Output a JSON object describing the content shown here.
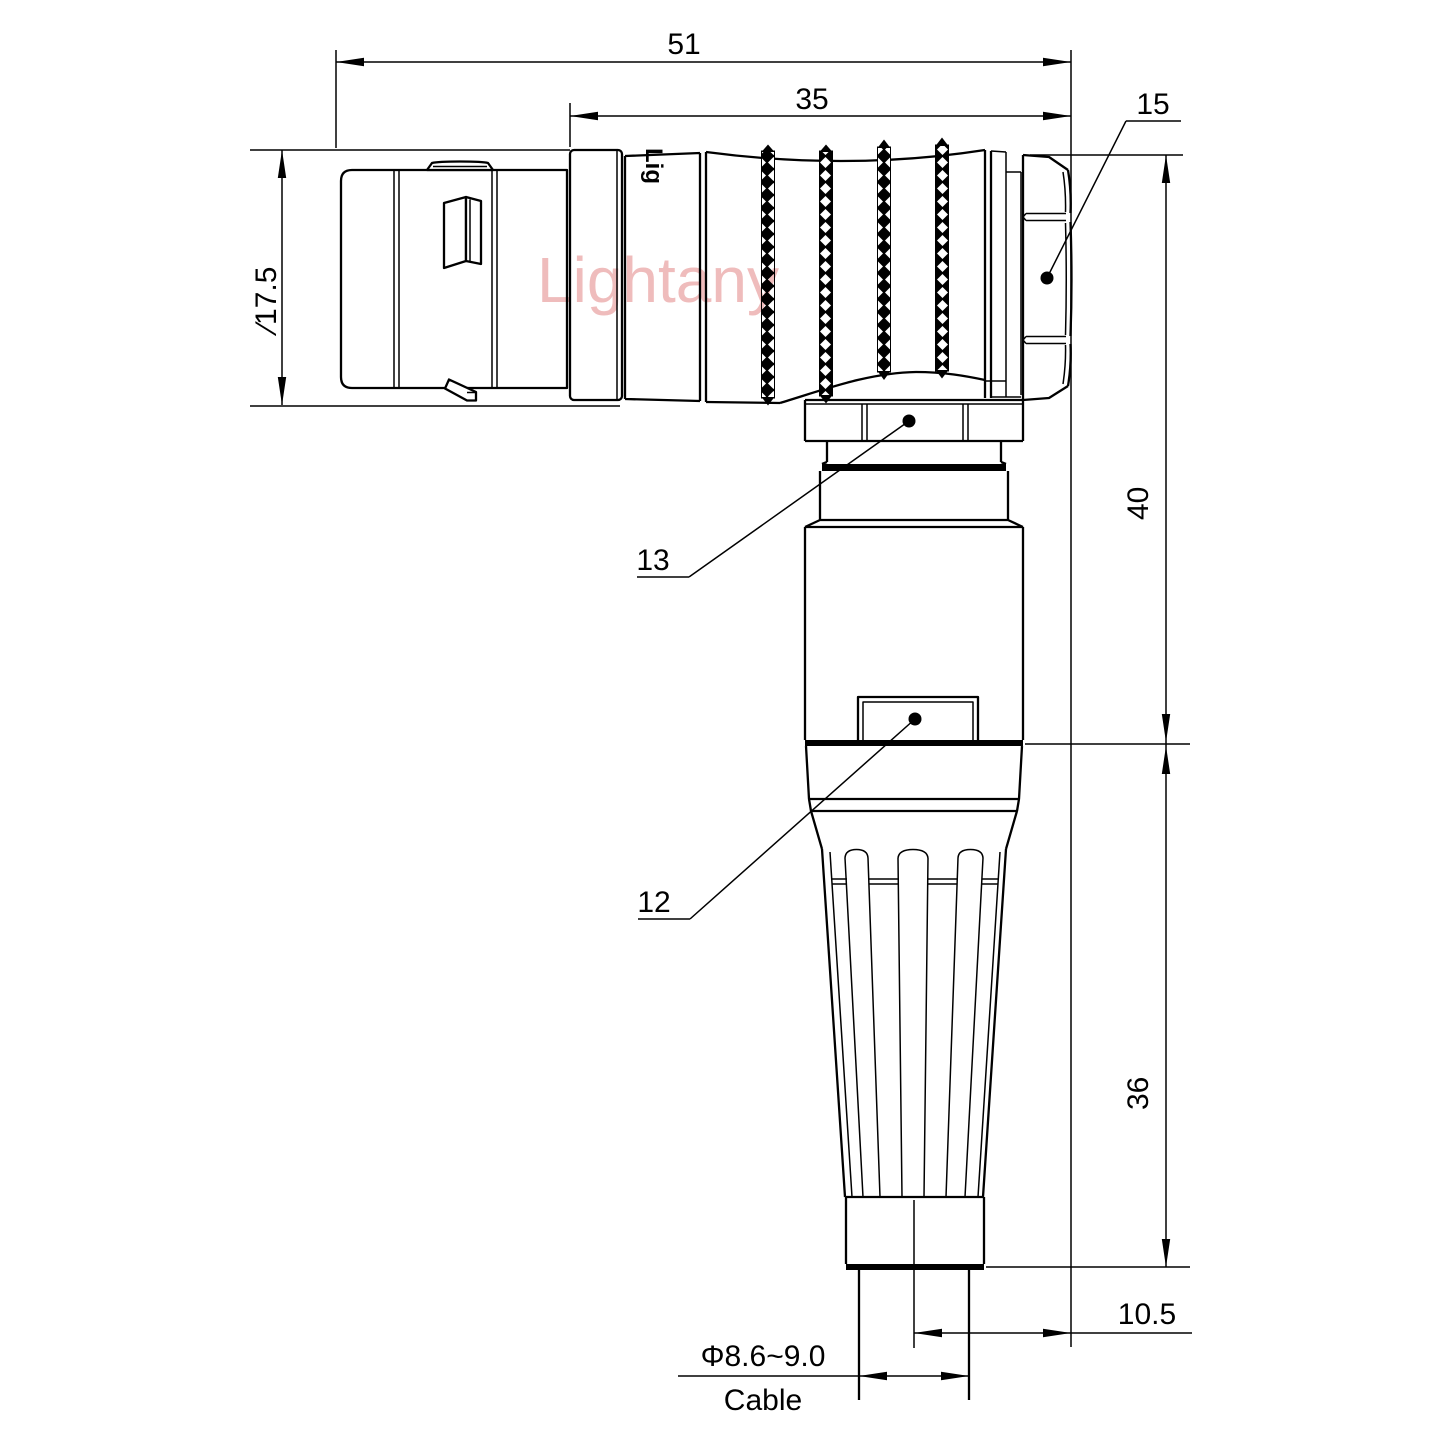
{
  "drawing": {
    "title": "right-angle circular connector technical drawing",
    "colors": {
      "background": "#ffffff",
      "line": "#000000",
      "watermark_pink": "#efbcbc"
    }
  },
  "watermark": {
    "text": "Lightany"
  },
  "engraving": {
    "text": "Lig"
  },
  "dimensions": {
    "overall_length": {
      "value": "51"
    },
    "body_length": {
      "value": "35"
    },
    "shell_diameter": {
      "value": "∕17.5"
    },
    "height_upper": {
      "value": "40"
    },
    "height_lower": {
      "value": "36"
    },
    "offset": {
      "value": "10.5"
    },
    "cable_diameter": {
      "value": "Φ8.6~9.0"
    },
    "cable_label": {
      "value": "Cable"
    }
  },
  "part_labels": {
    "hex_nut": {
      "value": "15"
    },
    "coupling_collar": {
      "value": "13"
    },
    "housing_boss": {
      "value": "12"
    }
  }
}
